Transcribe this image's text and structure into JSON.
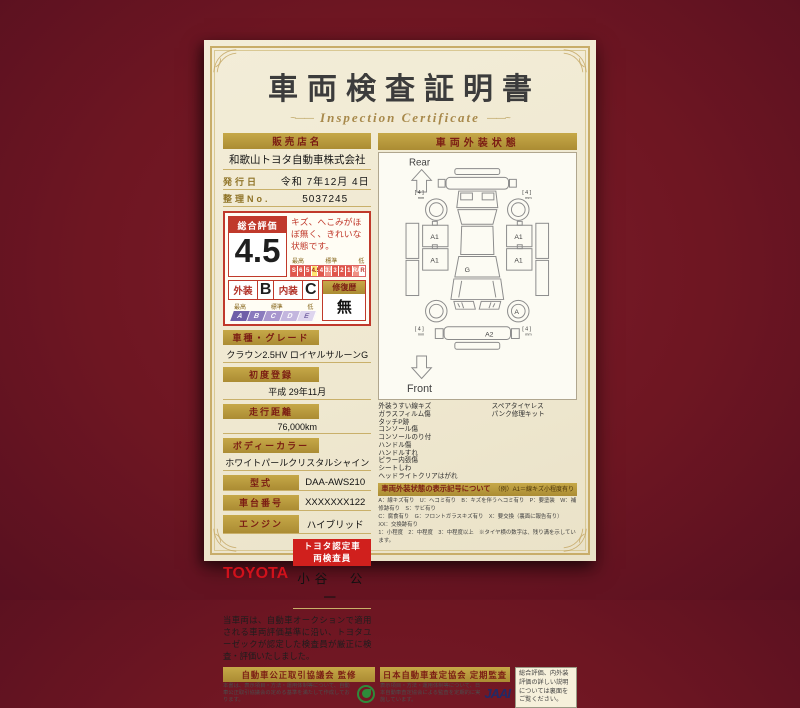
{
  "page": {
    "title": "車両検査証明書",
    "subtitle": "Inspection Certificate",
    "decor_left": "~——",
    "decor_right": "——~"
  },
  "dealer": {
    "label": "販売店名",
    "value": "和歌山トヨタ自動車株式会社"
  },
  "issue": {
    "label": "発行日",
    "value": "令和 7年12月 4日"
  },
  "ref_no": {
    "label": "整理No.",
    "value": "5037245"
  },
  "rating": {
    "overall_label": "総合評価",
    "overall_value": "4.5",
    "comment": "キズ、へこみがほぼ無く、きれいな状態です。",
    "scale_high": "最高",
    "scale_mid": "標準",
    "scale_low": "低",
    "scale": [
      "S",
      "6",
      "5",
      "4.5",
      "4",
      "3.5",
      "3",
      "2",
      "1",
      "RA",
      "R"
    ],
    "exterior_label": "外装",
    "exterior_value": "B",
    "interior_label": "内装",
    "interior_value": "C",
    "repair_label": "修復歴",
    "repair_value": "無",
    "grade_high": "最高",
    "grade_mid": "標準",
    "grade_low": "低",
    "grade_scale": [
      "A",
      "B",
      "C",
      "D",
      "E"
    ]
  },
  "fields": [
    {
      "label": "車種・グレード",
      "value": "クラウン2.5HV ロイヤルサルーンG"
    },
    {
      "label": "初度登録",
      "value": "平成 29年11月"
    },
    {
      "label": "走行距離",
      "value": "76,000km"
    },
    {
      "label": "ボディーカラー",
      "value": "ホワイトパールクリスタルシャイン"
    }
  ],
  "fields_inline": [
    {
      "label": "型式",
      "value": "DAA-AWS210"
    },
    {
      "label": "車台番号",
      "value": "XXXXXXX122"
    },
    {
      "label": "エンジン",
      "value": "ハイブリッド"
    }
  ],
  "inspector": {
    "brand": "TOYOTA",
    "badge": "トヨタ認定車両検査員",
    "name": "小谷　公一"
  },
  "disclaimer": "当車両は、自動車オークションで適用される車両評価基準に沿い、トヨタユーゼックが認定した検査員が厳正に検査・評価いたしました。",
  "exterior": {
    "header": "車両外装状態",
    "rear_label": "Rear",
    "front_label": "Front",
    "marks": {
      "door": "A1",
      "glass": "G",
      "wheel": "A",
      "bumper": "A2",
      "tread": "[ 4 ]",
      "tread_unit": "mm"
    },
    "notes_left": [
      "外装うすい線キズ",
      "ガラスフィルム傷",
      "タッチP跡",
      "コンソール傷",
      "コンソールのり付",
      "ハンドル傷",
      "ハンドルすれ",
      "ピラー内張傷",
      "シートしわ",
      "ヘッドライトクリアはがれ"
    ],
    "notes_right": [
      "スペアタイヤレス",
      "パンク修理キット"
    ],
    "legend_title": "車両外装状態の表示記号について",
    "legend_example": "（例）A1＝線キズ小程度有り",
    "legend_lines": [
      "A：線キズ有り　U：ヘコミ有り　B：キズを伴うヘコミ有り　P：要塗装　W：補修跡有り　S：サビ有り",
      "C：腐食有り　G：フロントガラスキズ有り　X：要交換（裏面に報告有り）　XX：交換跡有り",
      "1：小程度　2：中程度　3：中程度以上　※タイヤ横の数字は、残り溝を示しています。"
    ]
  },
  "footer": {
    "fair_trade": {
      "title": "自動車公正取引協議会 監修",
      "text": "本書は、表示項目・方法・運用体制等について、自動車公正取引協議会の定める基準を満たして作成しております。"
    },
    "jaai": {
      "title": "日本自動車査定協会 定期監査",
      "text": "表示項目・方法・運用体制等について、日本自動車査定協会による監査を定期的に実施しています。",
      "logo": "JAAI"
    },
    "note": "総合評価、内外装評価の詳しい説明については裏面をご覧ください。"
  }
}
